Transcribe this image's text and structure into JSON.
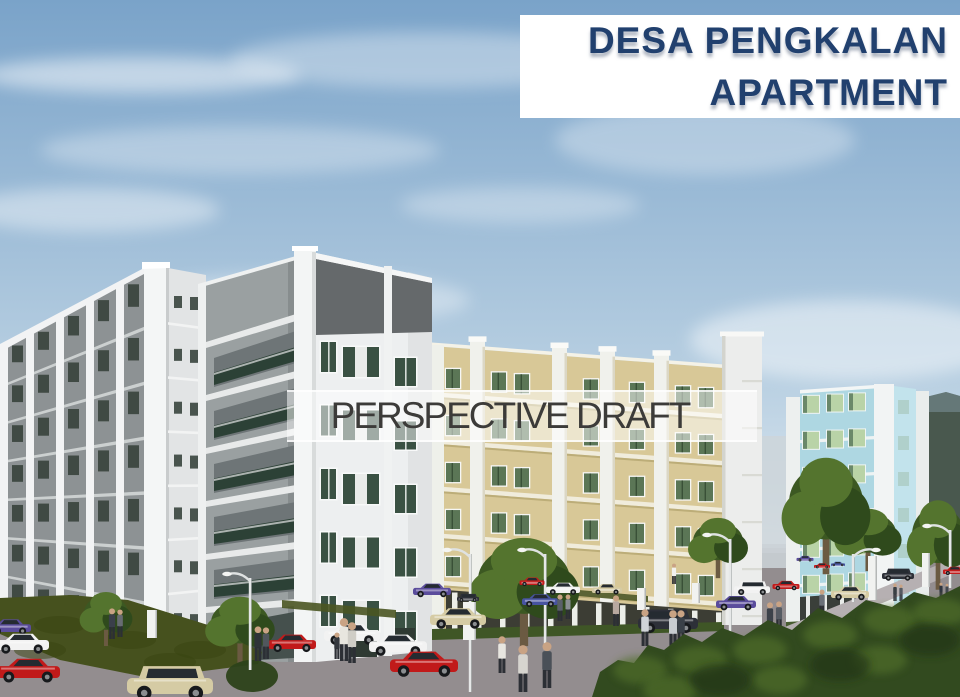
{
  "banner": {
    "line1": "DESA PENGKALAN",
    "line2": "APARTMENT"
  },
  "watermark": {
    "label": "PERSPECTIVE DRAFT"
  },
  "palette": {
    "sky_top": "#7aa3c9",
    "sky_mid": "#b9d0e2",
    "sky_low": "#e6edf4",
    "banner_bg": "#ffffff",
    "banner_text": "#21406e",
    "watermark_bg": "rgba(255,255,255,0.52)",
    "watermark_text": "#3c3b39",
    "mountain": "#49584e",
    "mountain_haze": "#8298a2",
    "gray_face": "#8d9294",
    "fin_white": "#f2f3f4",
    "window_dark": "#39443d",
    "center_front": "#edeff0",
    "center_band": "#65696b",
    "center_side": "#9aa0a1",
    "balcony_dark": "#6e7577",
    "window_green": "#3a5143",
    "frame_white": "#f8f9f9",
    "yellow_face": "#d8c897",
    "yellow_band": "#f0ecdc",
    "yellow_window": "#5b7656",
    "ground_opening": "#3c3d34",
    "blue_face": "#aed7e2",
    "blue_side": "#c2e3ec",
    "blue_window": "#b9d3a7",
    "road": "#938d8f",
    "sidewalk": "#b6b0b2",
    "grass": "#46511e",
    "forest": "#324a1f",
    "forest_light": "#51702c",
    "car_red": "#c11a1a",
    "car_white": "#f2f2f2",
    "car_beige": "#d5cba4",
    "car_purple": "#5a4c9c",
    "car_blue": "#4753a0",
    "car_dark": "#2d3038"
  }
}
